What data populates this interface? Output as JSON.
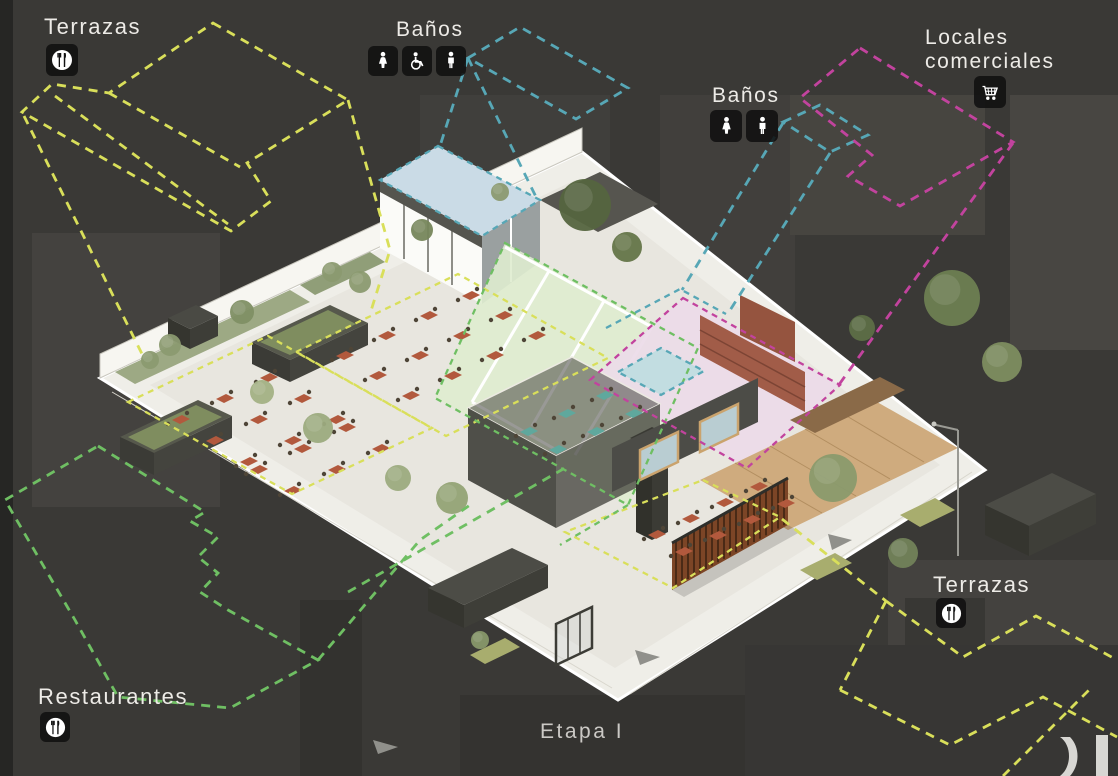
{
  "stage": {
    "label": "Etapa I"
  },
  "colors": {
    "background": "#3a3936",
    "terrazas_outline": "#d9df5a",
    "restaurantes_outline": "#6fbf63",
    "banos_outline": "#57a7b6",
    "locales_outline": "#c2439e",
    "label_text": "#edebe7"
  },
  "callouts": {
    "terrazas_top_left": {
      "label": "Terrazas",
      "icon": "restaurant-utensils"
    },
    "banos_top": {
      "label": "Baños",
      "icons": [
        "woman",
        "wheelchair-accessible",
        "man"
      ]
    },
    "locales_comerciales": {
      "label_line1": "Locales",
      "label_line2": "comerciales",
      "icon": "shopping-cart"
    },
    "banos_right": {
      "label": "Baños",
      "icons": [
        "woman",
        "man"
      ]
    },
    "terrazas_bottom_right": {
      "label": "Terrazas",
      "icon": "restaurant-utensils"
    },
    "restaurantes": {
      "label": "Restaurantes",
      "icon": "restaurant-utensils"
    }
  },
  "zones": [
    {
      "name": "Terrazas",
      "outline_color": "#d9df5a"
    },
    {
      "name": "Restaurantes",
      "outline_color": "#6fbf63"
    },
    {
      "name": "Baños",
      "outline_color": "#57a7b6"
    },
    {
      "name": "Locales comerciales",
      "outline_color": "#c2439e"
    }
  ]
}
